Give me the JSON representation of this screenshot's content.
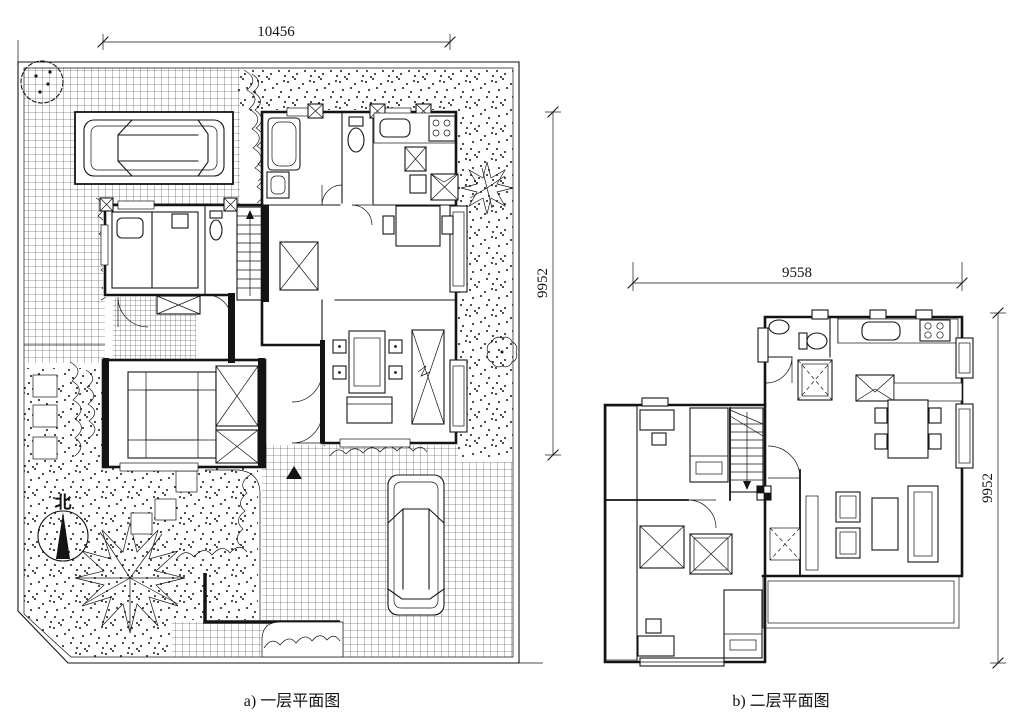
{
  "figure_labels": {
    "plan_a_caption": "a)  一层平面图",
    "plan_b_caption": "b)  二层平面图",
    "plan_a_dim_width": "10456",
    "plan_a_dim_height": "9952",
    "plan_b_dim_width": "9558",
    "plan_b_dim_height": "9952",
    "north_label": "北"
  },
  "colors": {
    "ink": "#141414",
    "paper": "#ffffff"
  }
}
